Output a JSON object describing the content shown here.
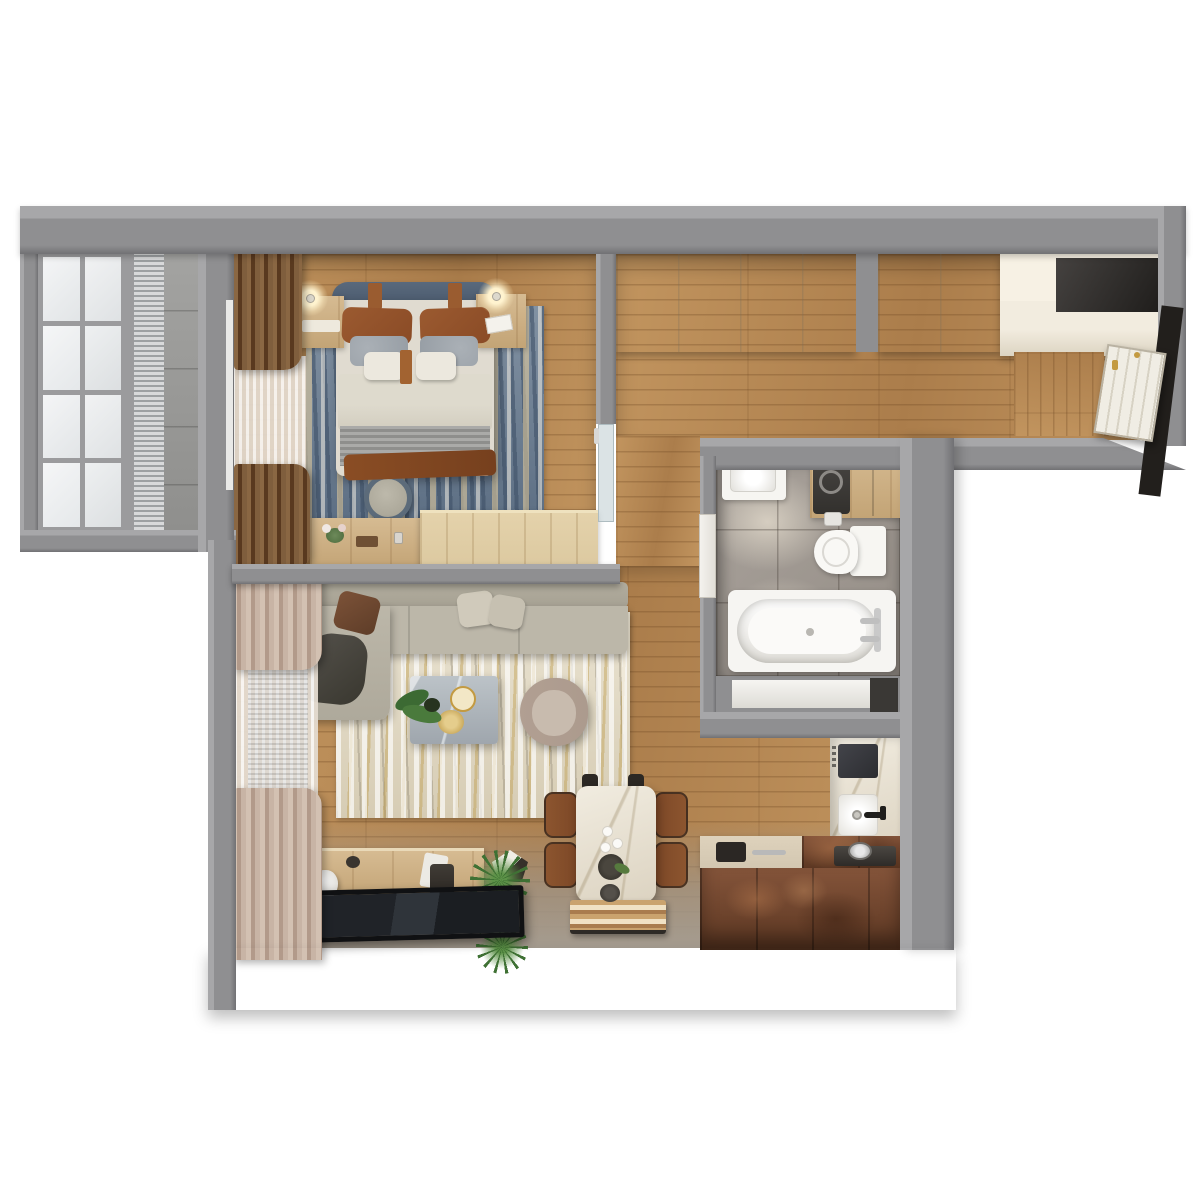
{
  "scene": {
    "kind": "3d-top-down-apartment-floor-plan-render",
    "background": "#ffffff",
    "text_visible": false
  },
  "palette": {
    "wall": "#8f8f91",
    "wallDark": "#717174",
    "wallLight": "#a7a7a9",
    "woodA": "#c2955f",
    "woodB": "#ab7d4b",
    "creamA": "#f2ecdf",
    "creamB": "#dcd4c2",
    "bathTileA": "#aaa39c",
    "bathTileB": "#938c85",
    "white": "#f7f6f2",
    "tileBalc": "#a3a3a1",
    "sheer": "#e8e1d7",
    "curtBrownA": "#7f5e3d",
    "curtBrownB": "#59391f",
    "curtPinkA": "#d3c1b2",
    "curtPinkB": "#b29a8a",
    "rugBlueA": "#8292a3",
    "rugBlueB": "#5d6f84",
    "rugLivA": "#eae3d1",
    "rugLivB": "#d6ccb4",
    "gold": "#c39a41",
    "sofaA": "#bcb7a9",
    "sofaB": "#a6a193",
    "leather": "#7d4827",
    "rustA": "#84543a",
    "rustB": "#5c3722",
    "islandTop": "#d3c7b1",
    "marbleGrayA": "#bcc3c8",
    "marbleGrayB": "#9fa6ad",
    "oakLight": "#dcc9a0",
    "headboard": "#47566a",
    "leatherPillow": "#8a4b26",
    "duvet": "#dedacd",
    "blanket": "#a0a09e",
    "throw": "#76401e",
    "tv": "#15161a",
    "green": "#3f7134",
    "greenL": "#5d9348",
    "armA": "#b19f92",
    "armB": "#c8bbae",
    "woodCab": "#c7a476",
    "glow": "#fff3cf"
  },
  "rooms": [
    {
      "id": "balcony",
      "label": "balcony",
      "items": [
        "window-grid",
        "venetian-blinds",
        "tile-floor"
      ]
    },
    {
      "id": "bedroom",
      "label": "bedroom",
      "items": [
        "double-bed",
        "upholstered-headboard",
        "leather-pillows",
        "duvet",
        "knit-blanket",
        "brown-throw",
        "nightstand-left",
        "nightstand-right",
        "table-lamp-left",
        "table-lamp-right",
        "blue-area-rug",
        "round-pouf",
        "dresser-console",
        "brown-curtains",
        "sheer-curtain",
        "low-divider-cabinet",
        "glass-door-to-hall"
      ]
    },
    {
      "id": "hallway",
      "label": "entry-hall",
      "items": [
        "built-in-wardrobe-left",
        "built-in-wardrobe-right",
        "storage-niche",
        "entry-cabinet",
        "wood-side-panel",
        "entry-door",
        "dark-door-frame"
      ]
    },
    {
      "id": "bathroom",
      "label": "bathroom",
      "items": [
        "washbasin",
        "basin-faucet",
        "washing-machine",
        "wood-cabinet",
        "toilet",
        "toilet-paper-holder",
        "bathtub",
        "bath-mixer",
        "bathroom-door",
        "shelf-niche",
        "gray-floor-tiles"
      ]
    },
    {
      "id": "kitchen",
      "label": "kitchen",
      "items": [
        "marble-counter",
        "induction-hob",
        "kitchen-sink",
        "black-faucet",
        "stove-with-pot",
        "rust-island-unit",
        "island-beige-top",
        "island-sink",
        "island-handle"
      ]
    },
    {
      "id": "living-room",
      "label": "living-room",
      "items": [
        "sectional-sofa",
        "chaise",
        "brown-cushion",
        "beige-cushions",
        "dark-throw-blanket",
        "beige-area-rug",
        "marble-coffee-table",
        "gold-tray",
        "gold-bowl",
        "table-plant",
        "curved-armchair",
        "tv-console",
        "cone-sculpture",
        "speaker",
        "flat-tv-panel",
        "spiky-plant-a",
        "spiky-plant-b",
        "dining-table",
        "dining-chairs-x4",
        "serving-mat",
        "sheer-curtains",
        "pleated-curtains",
        "window-blinds"
      ]
    }
  ]
}
